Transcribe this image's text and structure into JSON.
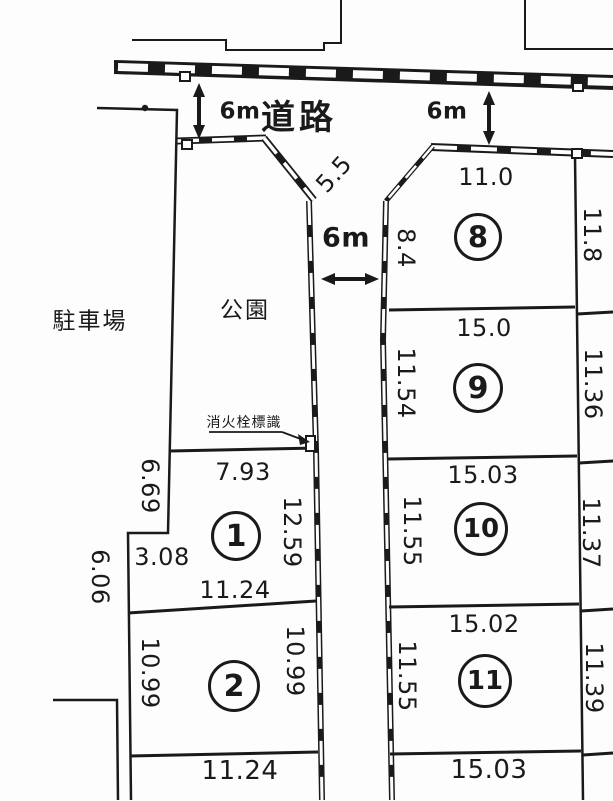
{
  "colors": {
    "ink": "#1a1a1a",
    "paper": "#fdfdfd"
  },
  "areas": {
    "road": "道路",
    "park": "公園",
    "parking": "駐車場"
  },
  "annotations": {
    "hydrant": "消火栓標識",
    "road_width_left": "6m",
    "road_width_right": "6m",
    "road_width_mid": "6m",
    "chamfer": "5.5",
    "outer_left": "6.06"
  },
  "plots": {
    "p1": {
      "num": "1",
      "top": "7.93",
      "left": "6.69",
      "step": "3.08",
      "right": "12.59",
      "bottom": "11.24"
    },
    "p2": {
      "num": "2",
      "left": "10.99",
      "right": "10.99",
      "bottom": "11.24"
    },
    "p8": {
      "num": "8",
      "top": "11.0",
      "left": "8.4",
      "right": "11.8"
    },
    "p9": {
      "num": "9",
      "top": "15.0",
      "left": "11.54",
      "right": "11.36"
    },
    "p10": {
      "num": "10",
      "top": "15.03",
      "left": "11.55",
      "right": "11.37"
    },
    "p11": {
      "num": "11",
      "top": "15.02",
      "left": "11.55",
      "right": "11.39"
    },
    "p_below": {
      "top": "15.03"
    }
  }
}
